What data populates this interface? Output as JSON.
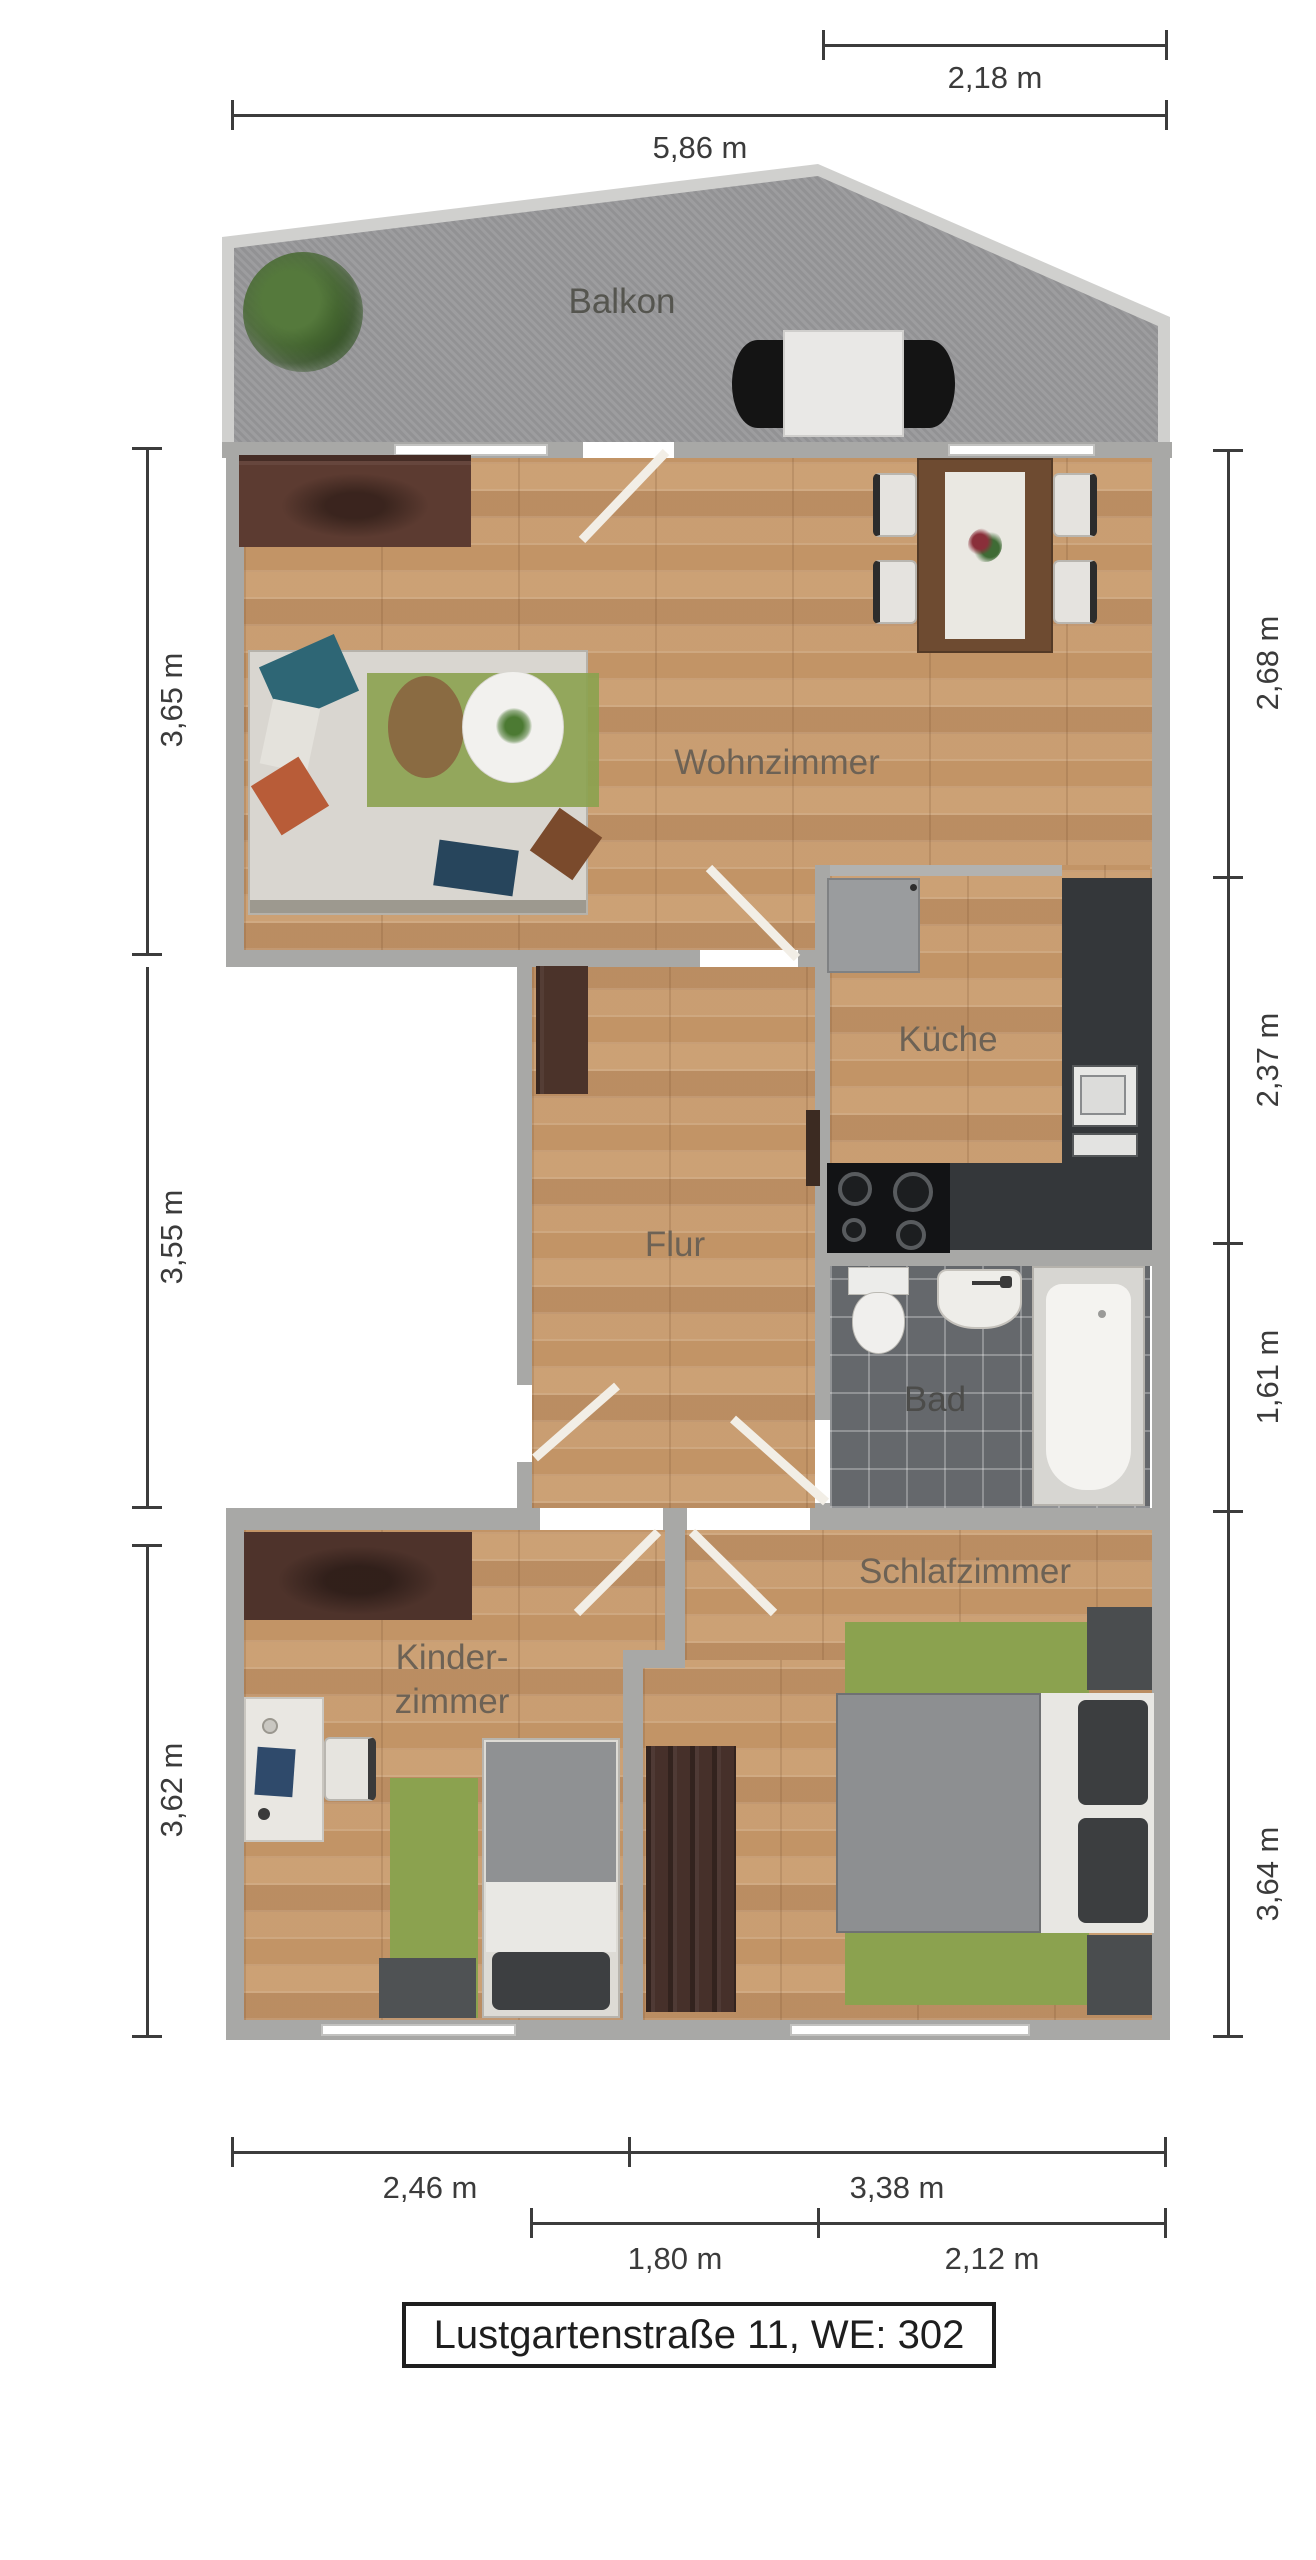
{
  "title": {
    "text": "Lustgartenstraße 11, WE: 302"
  },
  "rooms": {
    "balcony": "Balkon",
    "living": "Wohnzimmer",
    "kitchen": "Küche",
    "hall": "Flur",
    "bath": "Bad",
    "kids_line1": "Kinder-",
    "kids_line2": "zimmer",
    "bedroom": "Schlafzimmer"
  },
  "dimensions": {
    "top_small": "2,18 m",
    "top_large": "5,86 m",
    "left_upper": "3,65 m",
    "left_middle": "3,55 m",
    "left_lower": "3,62 m",
    "right_upper": "2,68 m",
    "right_upper_mid": "2,37 m",
    "right_lower_mid": "1,61 m",
    "right_lower": "3,64 m",
    "bottom_left": "2,46 m",
    "bottom_right": "3,38 m",
    "bottom_inner_left": "1,80 m",
    "bottom_inner_right": "2,12 m"
  },
  "palette": {
    "wall": "#a8a8a6",
    "wood": "#c69a6e",
    "balcony_floor": "#98989a",
    "balcony_rail": "#d0d0ce",
    "counter": "#34373a",
    "rug_green": "#8ba24f",
    "dark_brown": "#4e332b",
    "tile": "#65686c",
    "dim_text": "#3b3b3b",
    "room_text": "#6d6255",
    "door_white": "#f2eee6"
  }
}
